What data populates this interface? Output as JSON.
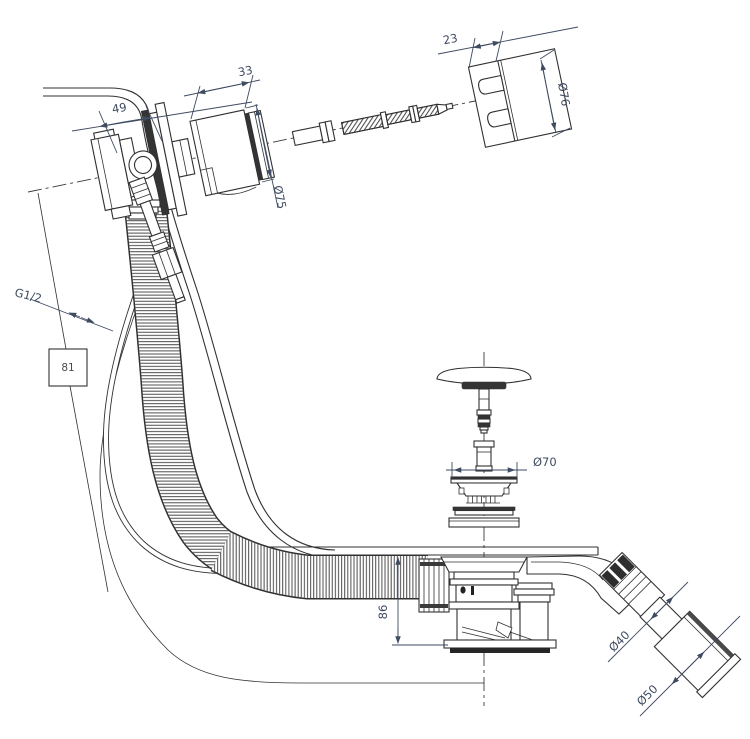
{
  "meta": {
    "title": "Bathtub waste and overflow assembly - technical installation drawing",
    "drawing_type": "exploded line diagram with dimensions"
  },
  "labels": {
    "overflow_offset": "49",
    "rosette_depth": "33",
    "rosette_dia": "Ø75",
    "cap_depth": "23",
    "cap_dia": "Ø76",
    "inlet_thread": "G1/2",
    "ref_box": "81",
    "plug_dia": "Ø70",
    "trap_height": "86",
    "outlet_dia": "Ø40",
    "sleeve_dia": "Ø50"
  },
  "colors": {
    "line": "#313131",
    "dimension_text": "#3f4b61",
    "dark_fill": "#343434",
    "background": "#ffffff"
  }
}
